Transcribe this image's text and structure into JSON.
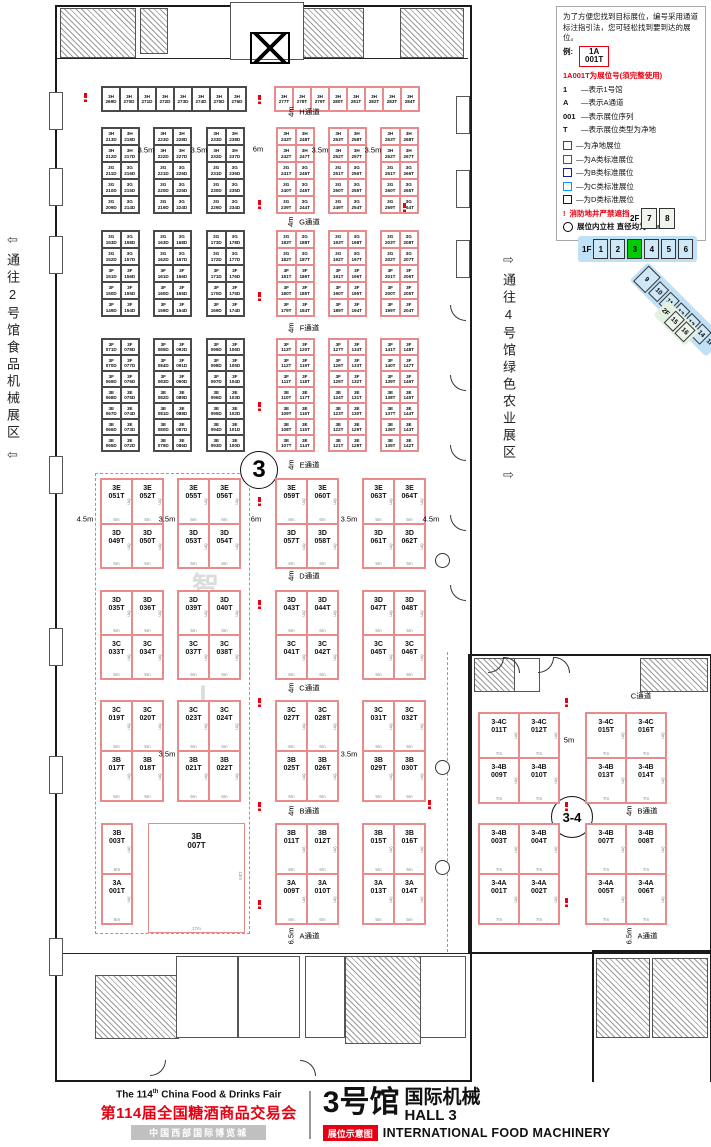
{
  "legend": {
    "intro": "为了方便您找到目标展位，编号采用通道标注指引法，您可轻松找到要到达的展位。",
    "example_label": "例:",
    "example_booth": "1A 001T",
    "note_red": "1A001T为展位号(须完整使用)",
    "items": [
      {
        "sym": "1",
        "text": "—表示1号馆"
      },
      {
        "sym": "A",
        "text": "—表示A通道"
      },
      {
        "sym": "001",
        "text": "—表示展位序列"
      },
      {
        "sym": "T",
        "text": "—表示展位类型为净地"
      }
    ],
    "swatches": [
      {
        "color": "#e60012",
        "text": "—为净地展位"
      },
      {
        "color": "#e4007f",
        "text": "—为A类标准展位"
      },
      {
        "color": "#1d2088",
        "text": "—为B类标准展位"
      },
      {
        "color": "#00a0e9",
        "text": "—为C类标准展位"
      },
      {
        "color": "#231815",
        "text": "—为D类标准展位"
      }
    ],
    "fire_mark": "!",
    "fire_note": "消防地井严禁遮挡",
    "pillar_note": "展位内立柱 直径均为1.5m"
  },
  "locator": {
    "f2_label": "2F",
    "f2_halls": [
      "7",
      "8"
    ],
    "f1_label": "1F",
    "f1_halls": [
      "1",
      "2",
      "3",
      "4",
      "5",
      "6"
    ],
    "current_hall": "3",
    "current_color": "#00cc00",
    "wing_halls": [
      "9",
      "10",
      "11",
      "12",
      "13",
      "14"
    ],
    "wing_f1_label": "1F",
    "wing_f2_label": "2F",
    "wing_f2_halls": [
      "15",
      "16"
    ]
  },
  "corridors": {
    "left_text": "通往2号馆食品机械展区",
    "left_arrow": "⇦",
    "right_text": "通往4号馆绿色农业展区",
    "right_arrow": "⇨"
  },
  "watermark": "智能AI专区",
  "circles": {
    "hall": "3",
    "link": "3-4"
  },
  "aisles": {
    "center": [
      {
        "name": "H通道",
        "w": "4m"
      },
      {
        "name": "G通道",
        "w": "4m"
      },
      {
        "name": "F通道",
        "w": "4m"
      },
      {
        "name": "E通道",
        "w": "4m"
      },
      {
        "name": "D通道",
        "w": "4m"
      },
      {
        "name": "C通道",
        "w": "4m"
      },
      {
        "name": "B通道",
        "w": "4m"
      },
      {
        "name": "A通道",
        "w": "6.5m"
      }
    ],
    "right": [
      {
        "name": "C通道",
        "w": ""
      },
      {
        "name": "B通道",
        "w": "4m"
      },
      {
        "name": "A通道",
        "w": "6.5m"
      }
    ]
  },
  "dims": [
    {
      "t": "3.5m",
      "x": 146,
      "y": 150
    },
    {
      "t": "3.5m",
      "x": 199,
      "y": 150
    },
    {
      "t": "6m",
      "x": 258,
      "y": 149
    },
    {
      "t": "3.5m",
      "x": 320,
      "y": 150
    },
    {
      "t": "3.5m",
      "x": 373,
      "y": 150
    },
    {
      "t": "4.5m",
      "x": 85,
      "y": 519
    },
    {
      "t": "3.5m",
      "x": 167,
      "y": 519
    },
    {
      "t": "6m",
      "x": 256,
      "y": 519
    },
    {
      "t": "3.5m",
      "x": 349,
      "y": 519
    },
    {
      "t": "4.5m",
      "x": 431,
      "y": 519
    },
    {
      "t": "3.5m",
      "x": 167,
      "y": 754
    },
    {
      "t": "3.5m",
      "x": 349,
      "y": 754
    },
    {
      "t": "5m",
      "x": 569,
      "y": 740
    }
  ],
  "plan": {
    "top_black": [
      "3H 269D",
      "3H 270D",
      "3H 271D",
      "3H 272D",
      "3H 273D",
      "3H 274D",
      "3H 275D",
      "3H 276D"
    ],
    "top_red": [
      "3H 277T",
      "3H 278T",
      "3H 279T",
      "3H 280T",
      "3H 281T",
      "3H 282T",
      "3H 283T",
      "3H 284T"
    ],
    "band1": [
      {
        "c": "k",
        "rows": [
          [
            "3H 213D",
            "3H 218D"
          ],
          [
            "3H 212D",
            "3H 217D"
          ],
          [
            "3G 211D",
            "3G 216D"
          ],
          [
            "3G 210D",
            "3G 215D"
          ],
          [
            "3G 209D",
            "3G 214D"
          ]
        ]
      },
      {
        "c": "k",
        "rows": [
          [
            "3H 223D",
            "3H 228D"
          ],
          [
            "3H 222D",
            "3H 227D"
          ],
          [
            "3G 221D",
            "3G 226D"
          ],
          [
            "3G 220D",
            "3G 225D"
          ],
          [
            "3G 219D",
            "3G 224D"
          ]
        ]
      },
      {
        "c": "k",
        "rows": [
          [
            "3H 233D",
            "3H 238D"
          ],
          [
            "3H 232D",
            "3H 237D"
          ],
          [
            "3G 231D",
            "3G 236D"
          ],
          [
            "3G 230D",
            "3G 235D"
          ],
          [
            "3G 229D",
            "3G 234D"
          ]
        ]
      },
      {
        "c": "r",
        "rows": [
          [
            "3H 243T",
            "3H 248T"
          ],
          [
            "3H 242T",
            "3H 247T"
          ],
          [
            "3G 241T",
            "3G 246T"
          ],
          [
            "3G 240T",
            "3G 245T"
          ],
          [
            "3G 239T",
            "3G 244T"
          ]
        ]
      },
      {
        "c": "r",
        "rows": [
          [
            "3H 253T",
            "3H 258T"
          ],
          [
            "3H 252T",
            "3H 257T"
          ],
          [
            "3G 251T",
            "3G 256T"
          ],
          [
            "3G 250T",
            "3G 255T"
          ],
          [
            "3G 249T",
            "3G 254T"
          ]
        ]
      },
      {
        "c": "r",
        "rows": [
          [
            "3H 263T",
            "3H 268T"
          ],
          [
            "3H 262T",
            "3H 267T"
          ],
          [
            "3G 261T",
            "3G 266T"
          ],
          [
            "3G 260T",
            "3G 265T"
          ],
          [
            "3G 259T",
            "3G 264T"
          ]
        ]
      }
    ],
    "band2": [
      {
        "c": "k",
        "rows": [
          [
            "3G 153D",
            "3G 158D"
          ],
          [
            "3G 152D",
            "3G 157D"
          ],
          [
            "3F 151D",
            "3F 156D"
          ],
          [
            "3F 150D",
            "3F 155D"
          ],
          [
            "3F 149D",
            "3F 154D"
          ]
        ]
      },
      {
        "c": "k",
        "rows": [
          [
            "3G 163D",
            "3G 168D"
          ],
          [
            "3G 162D",
            "3G 167D"
          ],
          [
            "3F 161D",
            "3F 166D"
          ],
          [
            "3F 160D",
            "3F 165D"
          ],
          [
            "3F 159D",
            "3F 164D"
          ]
        ]
      },
      {
        "c": "k",
        "rows": [
          [
            "3G 173D",
            "3G 178D"
          ],
          [
            "3G 172D",
            "3G 177D"
          ],
          [
            "3F 171D",
            "3F 176D"
          ],
          [
            "3F 170D",
            "3F 175D"
          ],
          [
            "3F 169D",
            "3F 174D"
          ]
        ]
      },
      {
        "c": "r",
        "rows": [
          [
            "3G 183T",
            "3G 188T"
          ],
          [
            "3G 182T",
            "3G 187T"
          ],
          [
            "3F 181T",
            "3F 186T"
          ],
          [
            "3F 180T",
            "3F 185T"
          ],
          [
            "3F 179T",
            "3F 184T"
          ]
        ]
      },
      {
        "c": "r",
        "rows": [
          [
            "3G 193T",
            "3G 198T"
          ],
          [
            "3G 192T",
            "3G 197T"
          ],
          [
            "3F 191T",
            "3F 196T"
          ],
          [
            "3F 190T",
            "3F 195T"
          ],
          [
            "3F 189T",
            "3F 194T"
          ]
        ]
      },
      {
        "c": "r",
        "rows": [
          [
            "3G 203T",
            "3G 208T"
          ],
          [
            "3G 202T",
            "3G 207T"
          ],
          [
            "3F 201T",
            "3F 206T"
          ],
          [
            "3F 200T",
            "3F 205T"
          ],
          [
            "3F 199T",
            "3F 204T"
          ]
        ]
      }
    ],
    "band3": [
      {
        "c": "k",
        "rows": [
          [
            "3F 071D",
            "3F 078D"
          ],
          [
            "3F 070D",
            "3F 077D"
          ],
          [
            "3F 069D",
            "3F 076D"
          ],
          [
            "3E 068D",
            "3E 075D"
          ],
          [
            "3E 067D",
            "3E 074D"
          ],
          [
            "3E 066D",
            "3E 073D"
          ],
          [
            "3E 065D",
            "3E 072D"
          ]
        ]
      },
      {
        "c": "k",
        "rows": [
          [
            "3F 085D",
            "3F 092D"
          ],
          [
            "3F 084D",
            "3F 091D"
          ],
          [
            "3F 083D",
            "3F 090D"
          ],
          [
            "3E 082D",
            "3E 089D"
          ],
          [
            "3E 081D",
            "3E 088D"
          ],
          [
            "3E 080D",
            "3E 087D"
          ],
          [
            "3E 079D",
            "3E 086D"
          ]
        ]
      },
      {
        "c": "k",
        "rows": [
          [
            "3F 099D",
            "3F 106D"
          ],
          [
            "3F 098D",
            "3F 105D"
          ],
          [
            "3F 097D",
            "3F 104D"
          ],
          [
            "3E 096D",
            "3E 103D"
          ],
          [
            "3E 095D",
            "3E 102D"
          ],
          [
            "3E 094D",
            "3E 101D"
          ],
          [
            "3E 093D",
            "3E 100D"
          ]
        ]
      },
      {
        "c": "r",
        "rows": [
          [
            "3F 113T",
            "3F 120T"
          ],
          [
            "3F 112T",
            "3F 119T"
          ],
          [
            "3F 111T",
            "3F 118T"
          ],
          [
            "3E 110T",
            "3E 117T"
          ],
          [
            "3E 109T",
            "3E 116T"
          ],
          [
            "3E 108T",
            "3E 115T"
          ],
          [
            "3E 107T",
            "3E 114T"
          ]
        ]
      },
      {
        "c": "r",
        "rows": [
          [
            "3F 127T",
            "3F 134T"
          ],
          [
            "3F 126T",
            "3F 133T"
          ],
          [
            "3F 125T",
            "3F 132T"
          ],
          [
            "3E 124T",
            "3E 131T"
          ],
          [
            "3E 123T",
            "3E 130T"
          ],
          [
            "3E 122T",
            "3E 129T"
          ],
          [
            "3E 121T",
            "3E 128T"
          ]
        ]
      },
      {
        "c": "r",
        "rows": [
          [
            "3F 141T",
            "3F 148T"
          ],
          [
            "3F 140T",
            "3F 147T"
          ],
          [
            "3F 139T",
            "3F 146T"
          ],
          [
            "3E 138T",
            "3E 145T"
          ],
          [
            "3E 137T",
            "3E 144T"
          ],
          [
            "3E 136T",
            "3E 143T"
          ],
          [
            "3E 135T",
            "3E 142T"
          ]
        ]
      }
    ],
    "band4": [
      {
        "c": "r",
        "w": "5m",
        "h": "8m",
        "rows": [
          [
            "3E 051T",
            "3E 052T"
          ],
          [
            "3D 049T",
            "3D 050T"
          ]
        ]
      },
      {
        "c": "r",
        "w": "6m",
        "h": "8m",
        "rows": [
          [
            "3E 055T",
            "3E 056T"
          ],
          [
            "3D 053T",
            "3D 054T"
          ]
        ]
      },
      {
        "c": "r",
        "w": "6m",
        "h": "8m",
        "rows": [
          [
            "3E 059T",
            "3E 060T"
          ],
          [
            "3D 057T",
            "3D 058T"
          ]
        ]
      },
      {
        "c": "r",
        "w": "5m",
        "h": "8m",
        "rows": [
          [
            "3E 063T",
            "3E 064T"
          ],
          [
            "3D 061T",
            "3D 062T"
          ]
        ]
      }
    ],
    "band5": [
      {
        "c": "r",
        "w": "5m",
        "h": "8m",
        "rows": [
          [
            "3D 035T",
            "3D 036T"
          ],
          [
            "3C 033T",
            "3C 034T"
          ]
        ]
      },
      {
        "c": "r",
        "w": "6m",
        "h": "8m",
        "rows": [
          [
            "3D 039T",
            "3D 040T"
          ],
          [
            "3C 037T",
            "3C 038T"
          ]
        ]
      },
      {
        "c": "r",
        "w": "6m",
        "h": "8m",
        "rows": [
          [
            "3D 043T",
            "3D 044T"
          ],
          [
            "3C 041T",
            "3C 042T"
          ]
        ]
      },
      {
        "c": "r",
        "w": "5m",
        "h": "8m",
        "rows": [
          [
            "3D 047T",
            "3D 048T"
          ],
          [
            "3C 045T",
            "3C 046T"
          ]
        ]
      }
    ],
    "band6": [
      {
        "c": "r",
        "w": "5m",
        "h": "8m",
        "rows": [
          [
            "3C 019T",
            "3C 020T"
          ],
          [
            "3B 017T",
            "3B 018T"
          ]
        ]
      },
      {
        "c": "r",
        "w": "6m",
        "h": "8m",
        "rows": [
          [
            "3C 023T",
            "3C 024T"
          ],
          [
            "3B 021T",
            "3B 022T"
          ]
        ]
      },
      {
        "c": "r",
        "w": "6m",
        "h": "8m",
        "rows": [
          [
            "3C 027T",
            "3C 028T"
          ],
          [
            "3B 025T",
            "3B 026T"
          ]
        ]
      },
      {
        "c": "r",
        "w": "5m",
        "h": "8m",
        "rows": [
          [
            "3C 031T",
            "3C 032T"
          ],
          [
            "3B 029T",
            "3B 030T"
          ]
        ]
      }
    ],
    "band7": [
      {
        "c": "r",
        "w": "5m",
        "h": "9m",
        "rows": [
          [
            "3B 003T"
          ],
          [
            "3A 001T"
          ]
        ]
      },
      {
        "c": "r",
        "big": "3B 007T",
        "w": "17m",
        "h": "13m"
      },
      {
        "c": "r",
        "w": "6m",
        "h": "9m",
        "rows": [
          [
            "3B 011T",
            "3B 012T"
          ],
          [
            "3A 009T",
            "3A 010T"
          ]
        ]
      },
      {
        "c": "r",
        "w": "5m",
        "h": "9m",
        "rows": [
          [
            "3B 015T",
            "3B 016T"
          ],
          [
            "3A 013T",
            "3A 014T"
          ]
        ]
      }
    ],
    "right_band1": [
      {
        "c": "r",
        "w": "7m",
        "h": "9m",
        "rows": [
          [
            "3-4C 011T",
            "3-4C 012T"
          ],
          [
            "3-4B 009T",
            "3-4B 010T"
          ]
        ]
      },
      {
        "c": "r",
        "w": "7m",
        "h": "9m",
        "rows": [
          [
            "3-4C 015T",
            "3-4C 016T"
          ],
          [
            "3-4B 013T",
            "3-4B 014T"
          ]
        ]
      }
    ],
    "right_band2": [
      {
        "c": "r",
        "w": "7m",
        "h": "9m",
        "rows": [
          [
            "3-4B 003T",
            "3-4B 004T"
          ],
          [
            "3-4A 001T",
            "3-4A 002T"
          ]
        ]
      },
      {
        "c": "r",
        "w": "7m",
        "h": "9m",
        "rows": [
          [
            "3-4B 007T",
            "3-4B 008T"
          ],
          [
            "3-4A 005T",
            "3-4A 006T"
          ]
        ]
      }
    ]
  },
  "footer": {
    "en_pre": "The 114",
    "en_sup": "th",
    "en_post": " China Food & Drinks Fair",
    "cn_title": "第114届全国糖酒商品交易会",
    "venue": "中国西部国际博览城",
    "hall_cn": "3号馆",
    "hall_sub": "国际机械",
    "hall_en": "HALL 3",
    "badge": "展位示意图",
    "en_sub": "INTERNATIONAL FOOD MACHINERY"
  }
}
